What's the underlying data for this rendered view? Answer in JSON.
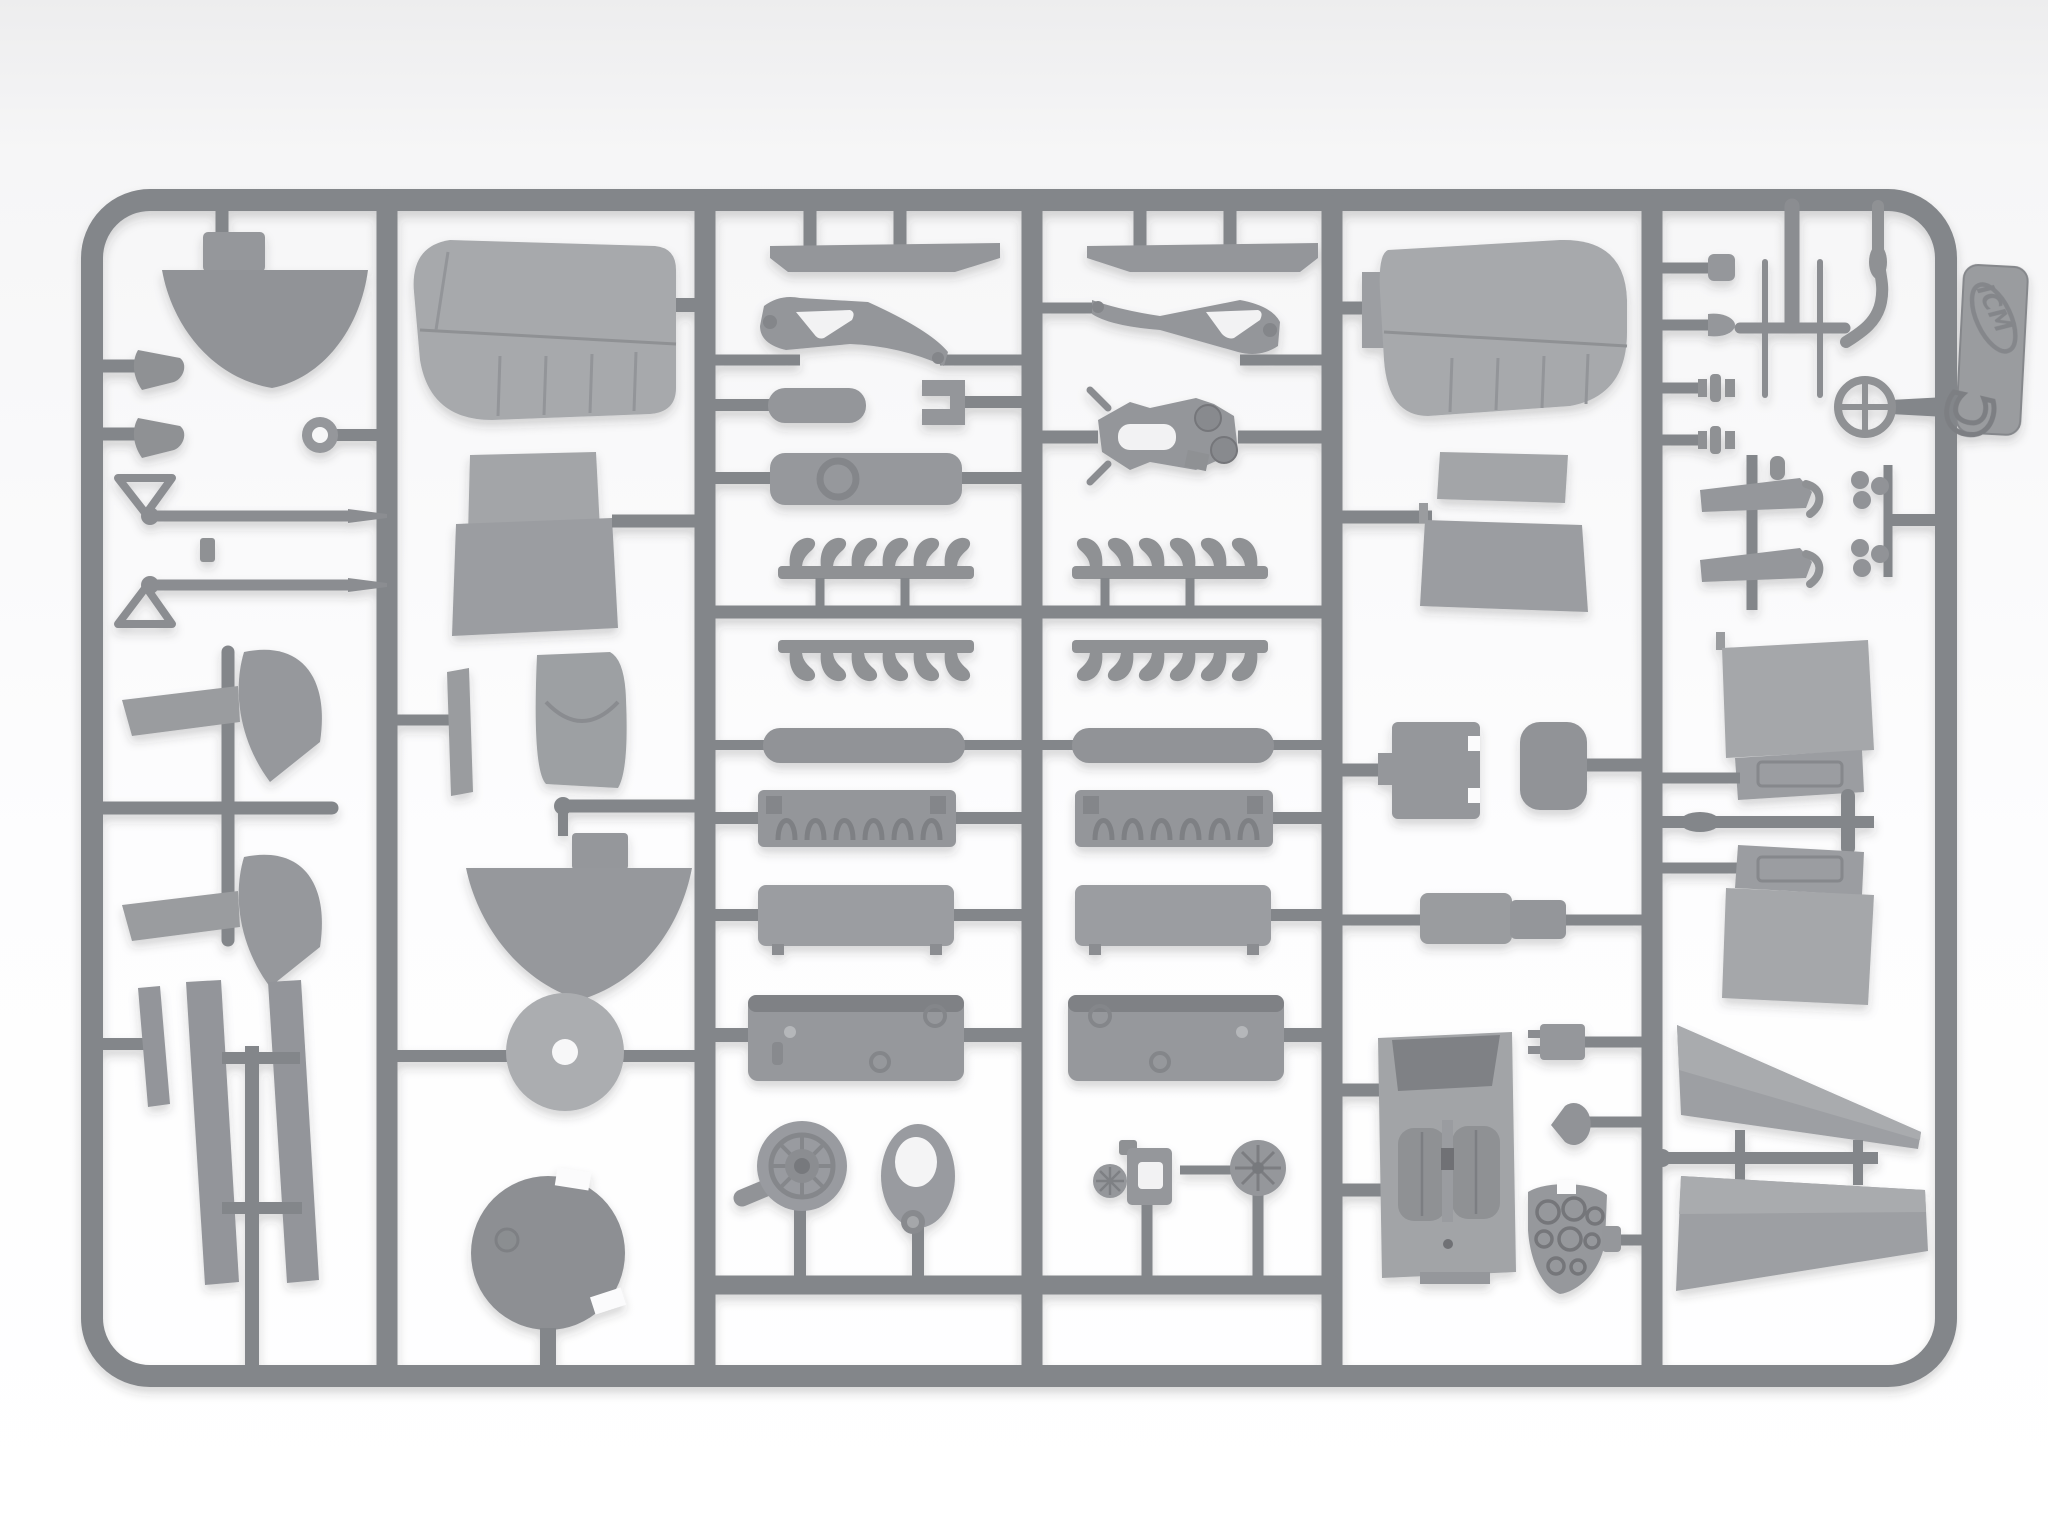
{
  "image_type": "photograph",
  "scene": {
    "description": "Overhead photo of a light-gray injection-molded plastic sprue (parts frame) from an ICM biplane model kit, laid on a white seamless background. The rounded rectangular runner frame is divided by five vertical runners into six columns densely packed with airframe and engine parts.",
    "background": "white seamless studio backdrop"
  },
  "sprue": {
    "brand": "ICM",
    "letter": "C",
    "plastic_color_name": "light gray",
    "frame_shape": "rounded rectangle",
    "columns": 6
  },
  "colors": {
    "background_top": "#eeeeef",
    "background_bottom": "#ffffff",
    "runner": "#83868a",
    "part_mid": "#97999d",
    "part_light": "#a7a9ac",
    "part_dark": "#888a8e",
    "detail_dark": "#77797d",
    "recess_white": "#f7f7f8",
    "shadow": "rgba(48,52,58,0.22)"
  },
  "counts": {
    "exhaust_stack_rows": 4,
    "exhaust_stacks_per_row": 6,
    "cam_loops_per_bank": 6,
    "engine_banks": 2,
    "valve_pins": 4,
    "instrument_dials": 8
  },
  "part_groups": [
    {
      "id": "nose-bowl",
      "label": "Fuselage nose bowl half"
    },
    {
      "id": "hook-fittings",
      "label": "Small exhaust hook fittings"
    },
    {
      "id": "towing-ring",
      "label": "Ring lug"
    },
    {
      "id": "machine-guns",
      "label": "Machine guns with ring sights"
    },
    {
      "id": "wingtip-fairings",
      "label": "Wingtip fairing and wedge pairs"
    },
    {
      "id": "strut-strips",
      "label": "Interplane strut strips"
    },
    {
      "id": "upper-wing",
      "label": "Upper wing half with rib detail"
    },
    {
      "id": "fuselage-panels",
      "label": "Curved fuselage panels"
    },
    {
      "id": "pilot-seat",
      "label": "Pilot seat"
    },
    {
      "id": "cowl-front",
      "label": "Cowling front half"
    },
    {
      "id": "cowl-disc",
      "label": "Cowling ring disc"
    },
    {
      "id": "spinner-dome",
      "label": "Spinner / cowl dome"
    },
    {
      "id": "cowl-strips",
      "label": "Cowl side strips"
    },
    {
      "id": "engine-bearers",
      "label": "Engine bearer brackets"
    },
    {
      "id": "oil-tank",
      "label": "Oil tank"
    },
    {
      "id": "radiator-plate",
      "label": "Radiator plate"
    },
    {
      "id": "exhaust-rows",
      "label": "Exhaust stack rows"
    },
    {
      "id": "valve-covers",
      "label": "Rocker cover cylinders"
    },
    {
      "id": "cam-banks",
      "label": "Camshaft banks with rocker loops"
    },
    {
      "id": "cylinder-blocks",
      "label": "Cylinder blocks"
    },
    {
      "id": "crankcases",
      "label": "Crankcase halves"
    },
    {
      "id": "supercharger",
      "label": "Supercharger volute"
    },
    {
      "id": "gear-ring",
      "label": "Reduction gear housing"
    },
    {
      "id": "carburetor",
      "label": "Carburetor assembly"
    },
    {
      "id": "magneto",
      "label": "Magneto cover"
    },
    {
      "id": "engine-mount",
      "label": "Engine mount frame"
    },
    {
      "id": "lower-wing",
      "label": "Lower wing half with rib detail"
    },
    {
      "id": "radiator-box",
      "label": "Radiator box and small tank"
    },
    {
      "id": "stepped-cylinder",
      "label": "Stepped cylinder"
    },
    {
      "id": "cockpit-floor",
      "label": "Cockpit floor with twin seats"
    },
    {
      "id": "radio-box",
      "label": "Radio box"
    },
    {
      "id": "headrest-pad",
      "label": "Headrest pad"
    },
    {
      "id": "instrument-panel",
      "label": "Instrument panel with dials"
    },
    {
      "id": "valve-pins",
      "label": "Valve pins and plugs"
    },
    {
      "id": "tail-tee",
      "label": "Tail skid tee with rods"
    },
    {
      "id": "control-stick",
      "label": "Control stick"
    },
    {
      "id": "control-wheel",
      "label": "Control wheel"
    },
    {
      "id": "float-blades",
      "label": "Float blade parts"
    },
    {
      "id": "stabilizers",
      "label": "Stabilizer halves with trim tabs"
    },
    {
      "id": "ailerons",
      "label": "Aileron strips"
    },
    {
      "id": "logo-tab",
      "label": "ICM logo tab, sprue letter C"
    }
  ]
}
